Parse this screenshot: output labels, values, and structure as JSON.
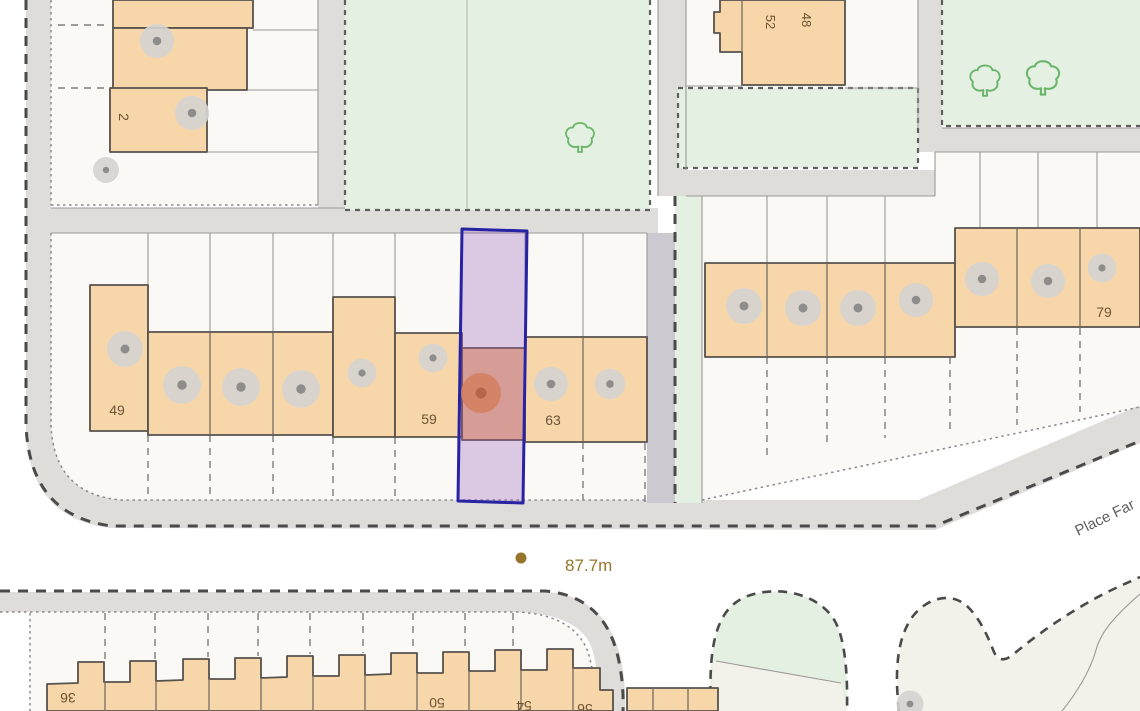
{
  "map": {
    "type": "site-plan-property-map",
    "labels": {
      "n2": "2",
      "n48": "48",
      "n52": "52",
      "n49": "49",
      "n59": "59",
      "n63": "63",
      "n79": "79",
      "n36": "36",
      "n50": "50",
      "n54": "54",
      "n56": "56",
      "spot_height": "87.7m",
      "street": "Place Far"
    },
    "highlight": {
      "description": "narrow vertical plot outlined in navy over house between 59 and 63"
    },
    "symbols": {
      "gray_canopy_circles": 19,
      "orange_canopy_circles": 1,
      "tree_outlines": 3,
      "spot_height_dots": 1
    }
  },
  "colors": {
    "building_fill": "#f7d7a9",
    "building_outline": "#57524c",
    "green_space": "#e4f0e1",
    "road": "#dfddda",
    "plot": "#faf9f5",
    "highlight_border": "#2823a4",
    "highlight_fill": "rgba(150,90,190,0.30)",
    "tree_outline": "#69b569",
    "canopy_gray": "#d5d3d1",
    "canopy_dot": "#8f8d8b",
    "canopy_orange": "#f3a94e",
    "canopy_orange_dot": "#bf7a1f",
    "label_brown": "#6b5335",
    "spot_height_color": "#96762c",
    "street_label_gray": "#5f5f5f"
  }
}
